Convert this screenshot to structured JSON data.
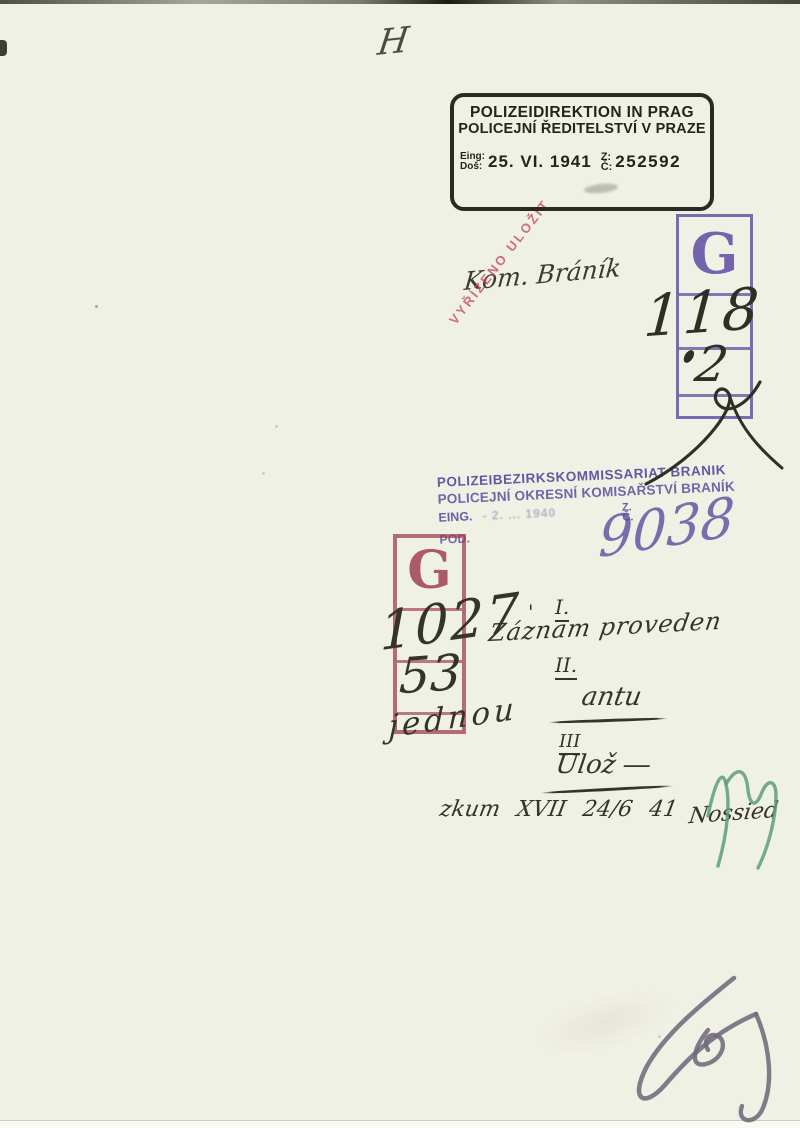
{
  "handwriting": {
    "top_mark": "H",
    "kom_branik": "Kom. Bráník",
    "g_upper_number": "118",
    "g_upper_sub": "2",
    "g_lower_line1": "1027",
    "g_lower_line2": "53",
    "g_lower_line3": "jednou",
    "branik_number": "9038",
    "tick": "'",
    "note1_label": "I.",
    "note1_text": "Záznam proveden",
    "note2_label": "II.",
    "note2_text": "antu",
    "note3_label": "III",
    "note3_text": "Ulož ―",
    "bottom_line": "zkum XVII 24/6 41",
    "signature": "Nossied"
  },
  "prague_stamp": {
    "line1": "POLIZEIDIREKTION IN PRAG",
    "line2": "POLICEJNÍ ŘEDITELSTVÍ V PRAZE",
    "received_label_top": "Eing:",
    "received_label_bottom": "Doš:",
    "date": "25. VI. 1941",
    "number_label_top": "Z:",
    "number_label_bottom": "Č:",
    "number": "252592"
  },
  "red_stamp": {
    "text": "VYŘÍZENO ULOŽIT"
  },
  "branik_stamp": {
    "line1": "POLIZEIBEZIRKSKOMMISSARIAT BRANIK",
    "line2": "POLICEJNÍ OKRESNÍ KOMISAŘSTVÍ BRANÍK",
    "eing_label": "EING.",
    "eing_date": "- 2. ... 1940",
    "pod_label": "POD.",
    "number_label_top": "Z.",
    "number_label_bottom": "Č."
  },
  "g_stamp": {
    "letter": "G"
  },
  "colors": {
    "paper": "#f0f1e5",
    "black_stamp_ink": "#24241e",
    "purple_stamp_ink": "#55479b",
    "purple_box_ink": "#6858a8",
    "red_box_ink": "#9e384c",
    "red_stamp_ink": "#c34860",
    "handwriting_ink": "#34342c",
    "green_pencil": "#5a9c82",
    "graphite_pencil": "#6f6a79"
  }
}
